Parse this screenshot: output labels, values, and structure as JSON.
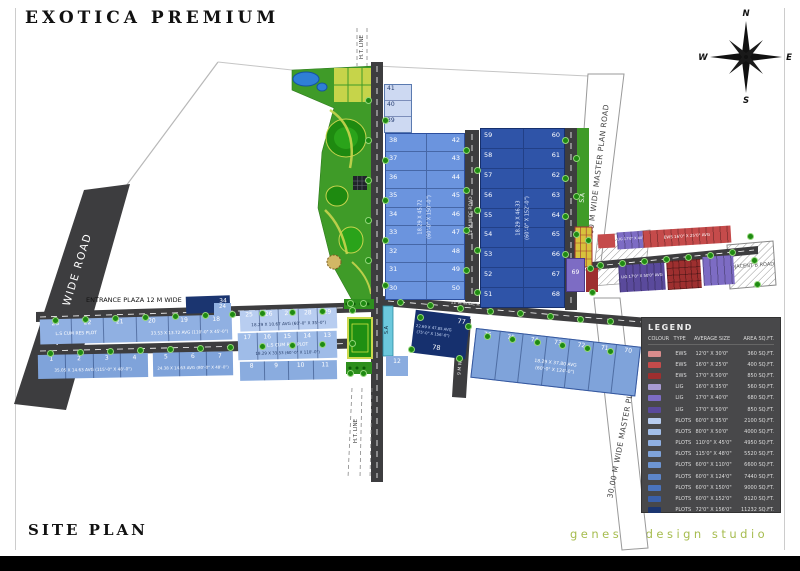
{
  "title": "EXOTICA PREMIUM",
  "footer": {
    "site_plan": "SITE PLAN",
    "studio": "genesis design studio"
  },
  "compass": {
    "n": "N",
    "e": "E",
    "s": "S",
    "w": "W"
  },
  "roads": {
    "wide_75": "75.00 M WIDE ROAD",
    "master_plan": "30.00 M WIDE MASTER PLAN ROAD",
    "entrance": "ENTRANCE PLAZA 12 M WIDE",
    "ht_line": "H.T. LINE",
    "road_12m": "12 M WIDE ROAD",
    "road_9m": "9 M WIDE ROAD",
    "sa": "S.A",
    "adjacent": "ADJACENT B ROAD"
  },
  "legend": {
    "title": "LEGEND",
    "columns": [
      "COLOUR",
      "TYPE",
      "AVERAGE SIZE",
      "AREA SQ.FT."
    ],
    "rows": [
      {
        "color": "#d98c8c",
        "type": "EWS",
        "size": "12'0\" X 30'0\"",
        "area": "360 SQ.FT."
      },
      {
        "color": "#c54b4b",
        "type": "EWS",
        "size": "16'0\" X 25'0\"",
        "area": "400 SQ.FT."
      },
      {
        "color": "#9e2f2f",
        "type": "EWS",
        "size": "17'0\" X 50'0\"",
        "area": "850 SQ.FT."
      },
      {
        "color": "#a79ad2",
        "type": "LIG",
        "size": "16'0\" X 35'0\"",
        "area": "560 SQ.FT."
      },
      {
        "color": "#7d6cc4",
        "type": "LIG",
        "size": "17'0\" X 40'0\"",
        "area": "680 SQ.FT."
      },
      {
        "color": "#5a4a9c",
        "type": "LIG",
        "size": "17'0\" X 50'0\"",
        "area": "850 SQ.FT."
      },
      {
        "color": "#b8cdf0",
        "type": "PLOTS",
        "size": "60'0\" X 35'0\"",
        "area": "2100 SQ.FT."
      },
      {
        "color": "#a3bfe9",
        "type": "PLOTS",
        "size": "80'0\" X 50'0\"",
        "area": "4000 SQ.FT."
      },
      {
        "color": "#90b0e2",
        "type": "PLOTS",
        "size": "110'0\" X 45'0\"",
        "area": "4950 SQ.FT."
      },
      {
        "color": "#7fa3da",
        "type": "PLOTS",
        "size": "115'0\" X 48'0\"",
        "area": "5520 SQ.FT."
      },
      {
        "color": "#6d95d3",
        "type": "PLOTS",
        "size": "60'0\" X 110'0\"",
        "area": "6600 SQ.FT."
      },
      {
        "color": "#5d86ca",
        "type": "PLOTS",
        "size": "60'0\" X 124'0\"",
        "area": "7440 SQ.FT."
      },
      {
        "color": "#4a74be",
        "type": "PLOTS",
        "size": "60'0\" X 150'0\"",
        "area": "9000 SQ.FT."
      },
      {
        "color": "#3a60aa",
        "type": "PLOTS",
        "size": "60'0\" X 152'0\"",
        "area": "9120 SQ.FT."
      },
      {
        "color": "#1b3570",
        "type": "PLOTS",
        "size": "72'0\" X 156'0\"",
        "area": "11232 SQ.FT."
      }
    ]
  },
  "blocks": {
    "top_small": {
      "numbers": [
        "41",
        "40",
        "39"
      ]
    },
    "block_a": {
      "left": [
        "38",
        "37",
        "36",
        "35",
        "34",
        "33",
        "32",
        "31",
        "30"
      ],
      "right": [
        "42",
        "43",
        "44",
        "45",
        "46",
        "47",
        "48",
        "49",
        "50"
      ],
      "size_m": "18.29 X 45.72",
      "size_ft": "(60'-0\" X 150'-0\")"
    },
    "block_b": {
      "left": [
        "59",
        "58",
        "57",
        "56",
        "55",
        "54",
        "53",
        "52",
        "51"
      ],
      "right": [
        "60",
        "61",
        "62",
        "63",
        "64",
        "65",
        "66",
        "67",
        "68"
      ],
      "size_m": "18.29 X 46.33",
      "size_ft": "(60'-0\" X 152'-0\")"
    },
    "row_a": {
      "numbers": [
        "23",
        "22",
        "21",
        "20",
        "19",
        "18"
      ],
      "label1": "L.S CUM RES PLOT",
      "label2": "33.53 X 13.72 AVG (110'-0\" X 45'-0\")"
    },
    "row_b1": {
      "numbers": [
        "1",
        "2",
        "3",
        "4"
      ],
      "label": "35.05 X 14.63 AVG (115'-0\" X 48'-0\")"
    },
    "row_b2": {
      "numbers": [
        "5",
        "6",
        "7"
      ],
      "label": "24.38 X 14.63 AVG (80'-0\" X 48'-0\")"
    },
    "mid_top": {
      "numbers": [
        "25",
        "26",
        "27",
        "28",
        "29"
      ],
      "label": "18.29 X 10.67 AVG (60'-0\" X 35'-0\")"
    },
    "mid_mid": {
      "numbers": [
        "17",
        "16",
        "15",
        "14",
        "13"
      ],
      "label1": "L.S CUM RES PLOT",
      "label2": "18.29 X 33.53 (60'-0\" X 110'-0\")"
    },
    "mid_bottom": {
      "numbers": [
        "8",
        "9",
        "10",
        "11"
      ]
    },
    "plot_12": "12",
    "plot_24": "24",
    "plot_34": "34",
    "plot_69": "69",
    "row_70": {
      "numbers": [
        "76",
        "75",
        "74",
        "73",
        "72",
        "71",
        "70"
      ],
      "size_m": "18.29 X 37.80 AVG",
      "size_ft": "(60'-0\" X 124'-0\")"
    },
    "block_77": {
      "num_top": "77",
      "num_bottom": "78",
      "size_m": "22.69 X 47.85 AVG",
      "size_ft": "(75'-0\" X 156'-0\")"
    },
    "ews_strip": {
      "ews_top": "EWS 16'0\" X 25'0\" AVG",
      "lig_top": "LIG 17'0\" X 40'0\" AVG",
      "lig_bottom": "LIG 17'0\" X 50'0\" AVG"
    }
  }
}
